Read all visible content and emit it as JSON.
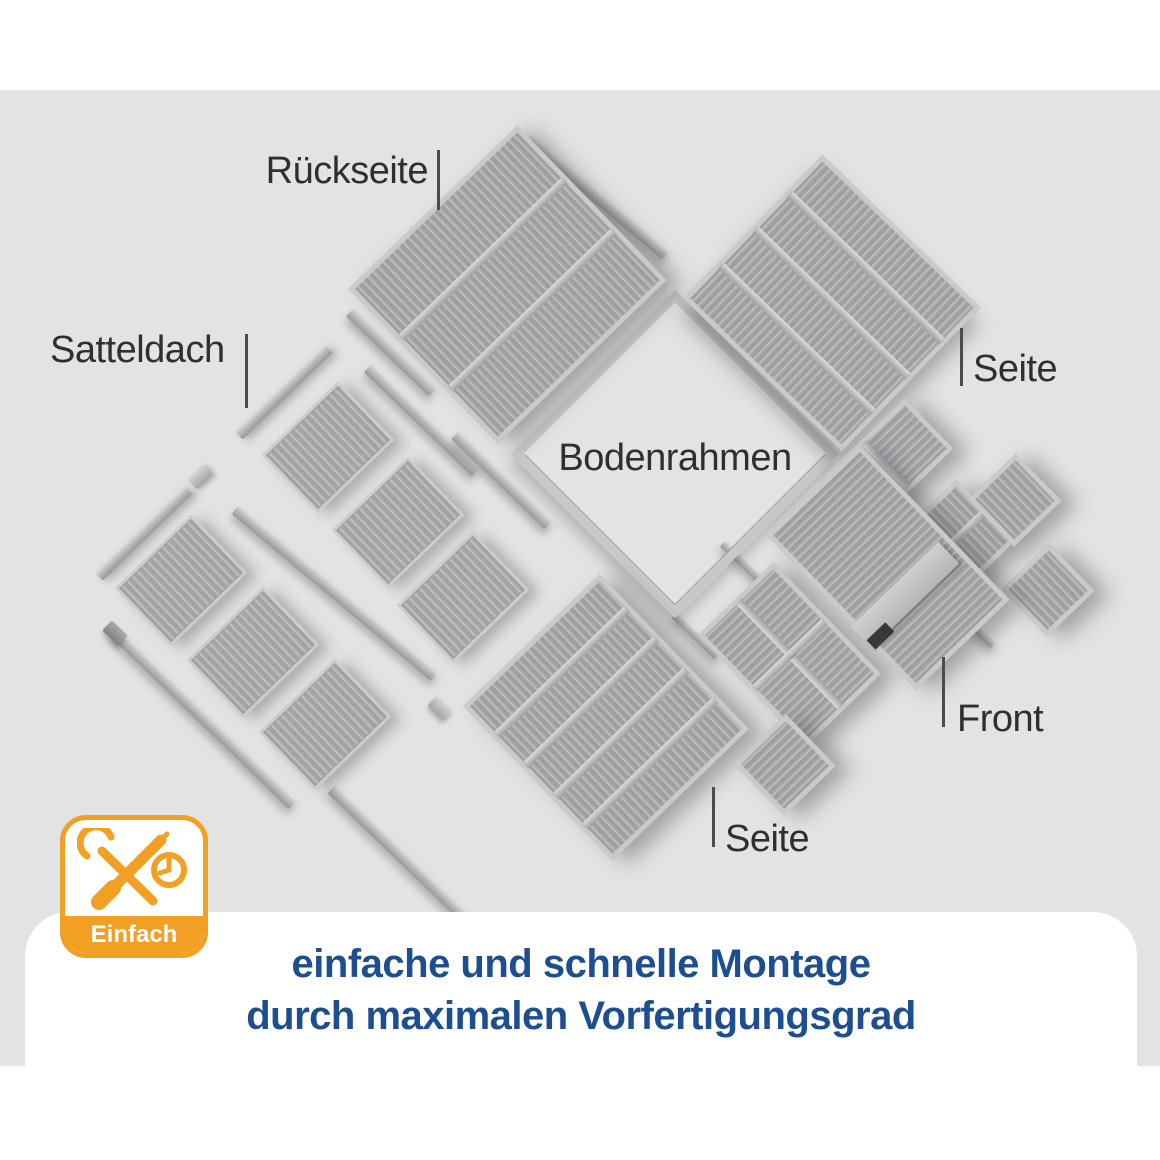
{
  "colors": {
    "background_gray": "#e2e3e2",
    "accent_orange": "#F2A024",
    "headline_blue": "#1D4E90",
    "label_dark": "#2e2f31",
    "panel_gray": "#b0b1b3"
  },
  "labels": {
    "rueckseite": "Rückseite",
    "satteldach": "Satteldach",
    "seite_top": "Seite",
    "bodenrahmen": "Bodenrahmen",
    "front": "Front",
    "seite_bottom": "Seite"
  },
  "badge": {
    "text": "Einfach"
  },
  "headline": {
    "line1": "einfache und schnelle Montage",
    "line2": "durch maximalen Vorfertigungsgrad"
  }
}
